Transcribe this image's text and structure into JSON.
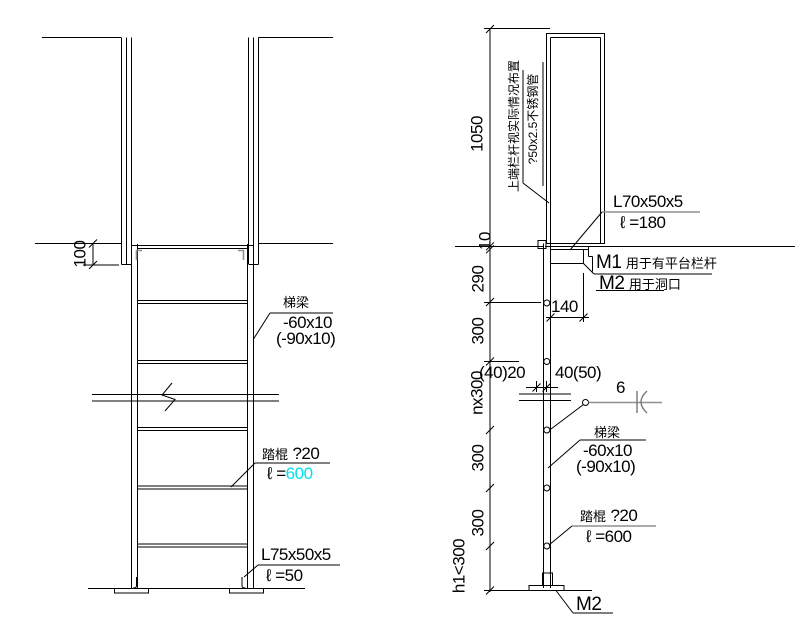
{
  "front_view": {
    "dim_100": "100",
    "beam": {
      "label": "梯梁",
      "size": "-60x10",
      "size_alt": "(-90x10)"
    },
    "rung": {
      "label": "踏棍",
      "spec": "?20",
      "length_prefix": "ℓ =",
      "length_value": "600"
    },
    "base_angle": {
      "label": "L75x50x5",
      "length": "ℓ =50"
    }
  },
  "side_view": {
    "dims": {
      "height_1050": "1050",
      "gap_10": "10",
      "seg_290": "290",
      "seg_300_top": "300",
      "seg_nx300": "nx300",
      "seg_300_mid": "300",
      "seg_300_low": "300",
      "seg_h1": "h1<300",
      "width_140": "140",
      "offset_left": "(40)20",
      "offset_right": "40(50)"
    },
    "rail_note_line1": "上端栏杆视实际情况布置",
    "rail_note_line2": "?50x2.5不锈钢管",
    "top_angle": {
      "label": "L70x50x5",
      "length": "ℓ =180"
    },
    "mark_notes": {
      "m1": "M1",
      "m1_text": "用于有平台栏杆",
      "m2": "M2",
      "m2_text": "用于洞口"
    },
    "weld_size": "6",
    "beam": {
      "label": "梯梁",
      "size": "-60x10",
      "size_alt": "(-90x10)"
    },
    "rung": {
      "label": "踏棍",
      "spec": "?20",
      "length": "ℓ =600"
    },
    "base_mark": "M2"
  },
  "colors": {
    "line": "#000000",
    "gray": "#8F8F8F",
    "cyan": "#00E0F0",
    "background": "#FFFFFF"
  }
}
